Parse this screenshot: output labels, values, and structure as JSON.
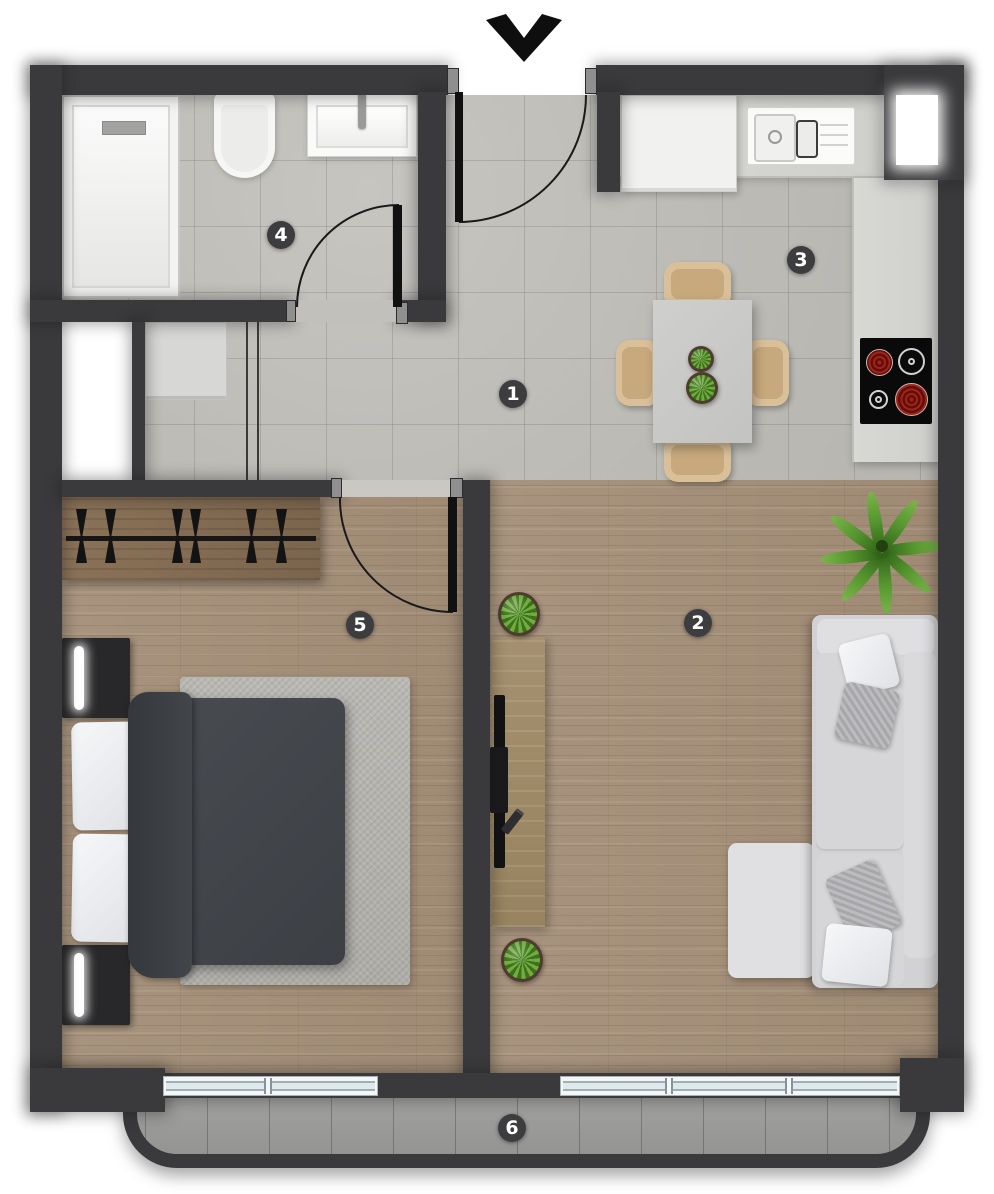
{
  "floor_plan": {
    "room_markers": [
      {
        "number": "1"
      },
      {
        "number": "2"
      },
      {
        "number": "3"
      },
      {
        "number": "4"
      },
      {
        "number": "5"
      },
      {
        "number": "6"
      }
    ],
    "icons": {
      "entrance_arrow": "chevron-down"
    },
    "colors": {
      "wall": "#3a3a3c",
      "tile_floor": "#c1bfba",
      "wood_floor": "#a6937e",
      "balcony_floor": "#9c9c9a",
      "marker_background": "#3d3d3f",
      "marker_text": "#ffffff",
      "burner_red": "#9c2016",
      "chair_beige": "#d9c099",
      "sofa_gray": "#d4d4d7"
    }
  }
}
